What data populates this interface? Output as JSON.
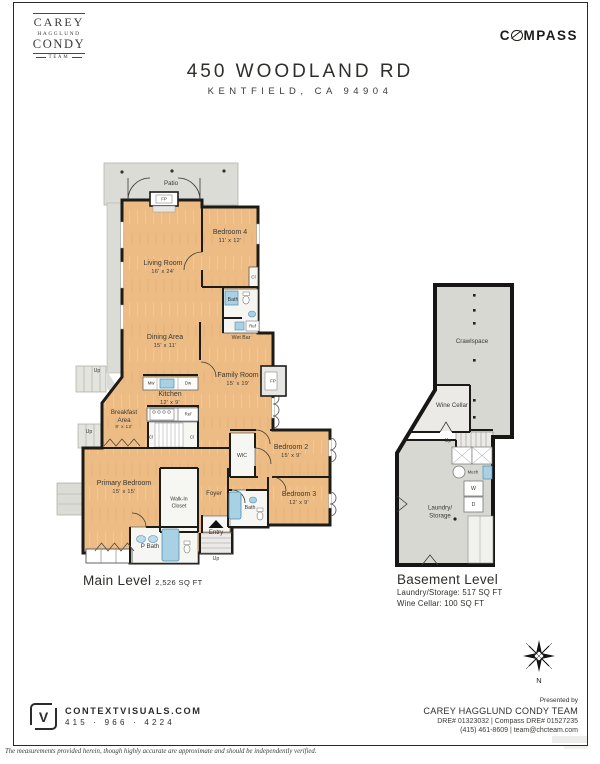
{
  "header": {
    "team_logo": {
      "line1": "CAREY",
      "line2": "HAGGLUND",
      "line3": "CONDY",
      "team": "TEAM"
    },
    "compass": {
      "pre": "C",
      "post": "MPASS"
    },
    "title": "450 WOODLAND RD",
    "subtitle": "KENTFIELD, CA  94904"
  },
  "main_level": {
    "title": "Main Level",
    "area": "2,526 SQ FT",
    "rooms": {
      "patio": {
        "name": "Patio"
      },
      "living": {
        "name": "Living Room",
        "dims": "16' x 24'"
      },
      "bedroom4": {
        "name": "Bedroom 4",
        "dims": "11' x 12'"
      },
      "bath_upper": {
        "name": "Bath"
      },
      "wet_bar": {
        "name": "Wet Bar"
      },
      "dining": {
        "name": "Dining Area",
        "dims": "15' x 11'"
      },
      "family": {
        "name": "Family Room",
        "dims": "15' x 19'"
      },
      "kitchen": {
        "name": "Kitchen",
        "dims": "12' x 9'"
      },
      "breakfast": {
        "name": "Breakfast\nArea",
        "dims": "8' x 12'"
      },
      "primary": {
        "name": "Primary Bedroom",
        "dims": "15' x 15'"
      },
      "walkin": {
        "name": "Walk-In\nCloset"
      },
      "foyer": {
        "name": "Foyer"
      },
      "entry": {
        "name": "Entry"
      },
      "wic": {
        "name": "WIC"
      },
      "bedroom2": {
        "name": "Bedroom 2",
        "dims": "15' x 9'"
      },
      "bedroom3": {
        "name": "Bedroom 3",
        "dims": "12' x 9'"
      },
      "pbath": {
        "name": "P Bath"
      },
      "bath_lower": {
        "name": "Bath"
      }
    }
  },
  "basement_level": {
    "title": "Basement Level",
    "stats": [
      "Laundry/Storage: 517 SQ FT",
      "Wine Cellar: 100 SQ FT"
    ],
    "rooms": {
      "crawlspace": {
        "name": "Crawlspace"
      },
      "wine": {
        "name": "Wine Cellar"
      },
      "laundry": {
        "name": "Laundry/\nStorage"
      }
    }
  },
  "annotations": {
    "up": "Up",
    "fp": "FP",
    "mw": "Mw",
    "dw": "Dw",
    "ref": "Ref",
    "cl": "Cl",
    "mech": "Mech",
    "w": "W",
    "d": "D",
    "north": "N"
  },
  "footer": {
    "contextvisuals": {
      "logo_letter": "V",
      "site": "CONTEXTVISUALS.COM",
      "phone": "415 · 966 · 4224"
    },
    "presented_by": "Presented by",
    "team": "CAREY HAGGLUND CONDY TEAM",
    "dre": "DRE# 01323032  |  Compass DRE# 01527235",
    "contact": "(415) 461-8609  |  team@chcteam.com"
  },
  "disclaimer": "The measurements provided herein, though highly accurate are approximate and should be independently verified.",
  "colors": {
    "floor": "#ecbc84",
    "hardscape": "#dcdcd7",
    "wall": "#1d1b18",
    "fixture_blue": "#a8d2e4"
  }
}
